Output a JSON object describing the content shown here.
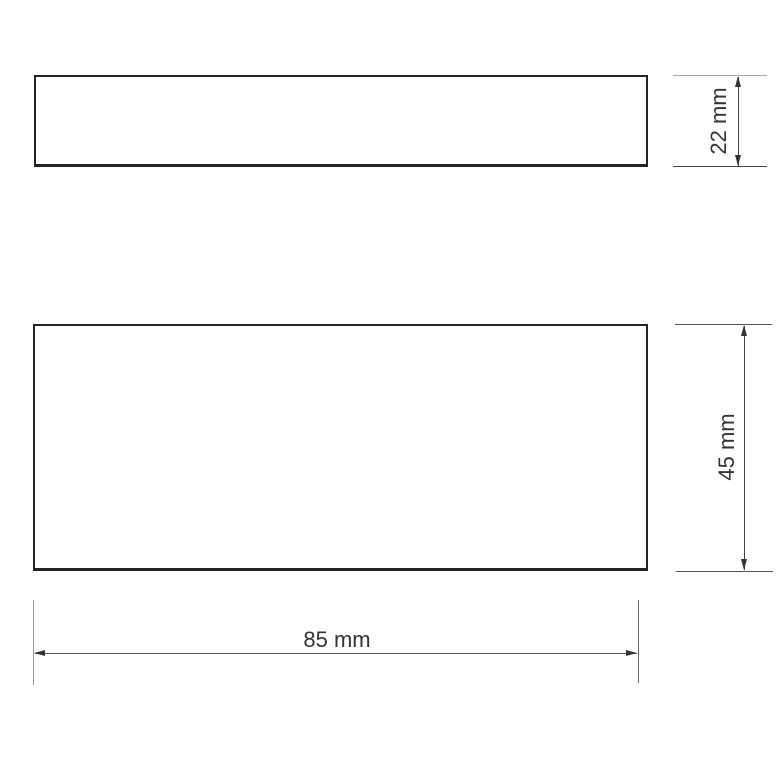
{
  "drawing": {
    "type": "technical-dimension-drawing",
    "views": {
      "side_view": {
        "shape": "rectangle"
      },
      "front_view": {
        "shape": "rectangle"
      }
    },
    "dimensions": {
      "thickness": {
        "label": "22 mm",
        "value": 22,
        "unit": "mm",
        "orientation": "vertical"
      },
      "height": {
        "label": "45 mm",
        "value": 45,
        "unit": "mm",
        "orientation": "vertical"
      },
      "width": {
        "label": "85 mm",
        "value": 85,
        "unit": "mm",
        "orientation": "horizontal"
      }
    },
    "colors": {
      "background": "#ffffff",
      "outline": "#242424",
      "dimension_line": "#444444",
      "extension_line_light": "#aaaaaa",
      "label_text": "#333333"
    }
  }
}
